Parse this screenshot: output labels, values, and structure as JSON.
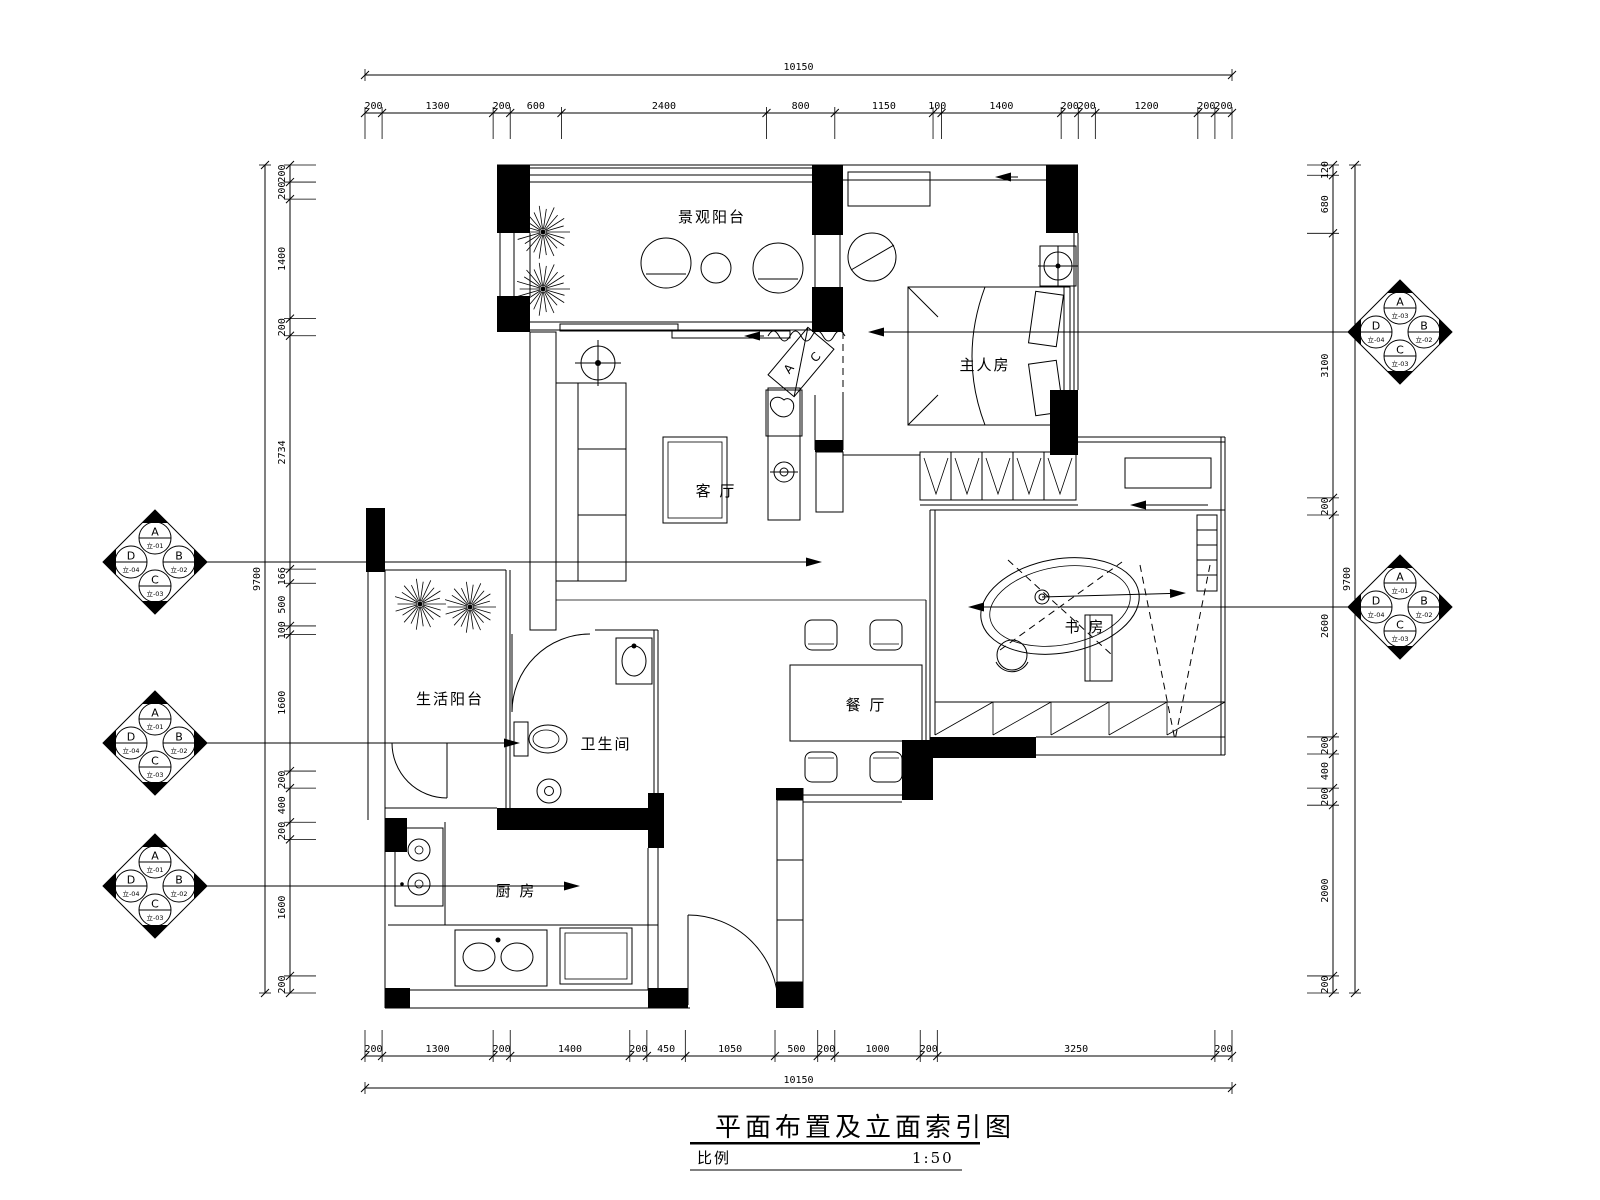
{
  "title_block": {
    "title": "平面布置及立面索引图",
    "scale_label": "比例",
    "scale_value": "1:50"
  },
  "dims": {
    "top": {
      "total": "10150",
      "segments": [
        200,
        1300,
        200,
        600,
        2400,
        800,
        1150,
        100,
        1400,
        200,
        200,
        1200,
        200,
        200
      ]
    },
    "bottom": {
      "total": "10150",
      "segments": [
        200,
        1300,
        200,
        1400,
        200,
        450,
        1050,
        500,
        200,
        1000,
        200,
        3250,
        200
      ]
    },
    "left": {
      "total": "9700",
      "segments": [
        200,
        200,
        1400,
        200,
        2734,
        166,
        500,
        100,
        1600,
        200,
        400,
        200,
        1600,
        200
      ]
    },
    "right": {
      "total": "9700",
      "segments": [
        120,
        680,
        3100,
        200,
        2600,
        200,
        400,
        200,
        2000,
        200
      ]
    }
  },
  "rooms": [
    {
      "name": "景观阳台"
    },
    {
      "name": "主人房"
    },
    {
      "name": "客 厅"
    },
    {
      "name": "生活阳台"
    },
    {
      "name": "卫生间"
    },
    {
      "name": "餐 厅"
    },
    {
      "name": "书 房"
    },
    {
      "name": "厨 房"
    }
  ],
  "labels": {
    "ac_top": "A",
    "ac_bottom": "C"
  },
  "elevation_symbols": [
    {
      "id": "left-living",
      "quadrants": {
        "top": {
          "letter": "A",
          "code": "立-01"
        },
        "right": {
          "letter": "B",
          "code": "立-02"
        },
        "bottom": {
          "letter": "C",
          "code": "立-03"
        },
        "left": {
          "letter": "D",
          "code": "立-04"
        }
      }
    },
    {
      "id": "left-bath",
      "quadrants": {
        "top": {
          "letter": "A",
          "code": "立-01"
        },
        "right": {
          "letter": "B",
          "code": "立-02"
        },
        "bottom": {
          "letter": "C",
          "code": "立-03"
        },
        "left": {
          "letter": "D",
          "code": "立-04"
        }
      }
    },
    {
      "id": "left-kitchen",
      "quadrants": {
        "top": {
          "letter": "A",
          "code": "立-01"
        },
        "right": {
          "letter": "B",
          "code": "立-02"
        },
        "bottom": {
          "letter": "C",
          "code": "立-03"
        },
        "left": {
          "letter": "D",
          "code": "立-04"
        }
      }
    },
    {
      "id": "right-master",
      "quadrants": {
        "top": {
          "letter": "A",
          "code": "立-03"
        },
        "right": {
          "letter": "B",
          "code": "立-02"
        },
        "bottom": {
          "letter": "C",
          "code": "立-03"
        },
        "left": {
          "letter": "D",
          "code": "立-04"
        }
      }
    },
    {
      "id": "right-study",
      "quadrants": {
        "top": {
          "letter": "A",
          "code": "立-01"
        },
        "right": {
          "letter": "B",
          "code": "立-02"
        },
        "bottom": {
          "letter": "C",
          "code": "立-03"
        },
        "left": {
          "letter": "D",
          "code": "立-04"
        }
      }
    }
  ],
  "colors": {
    "line": "#000000",
    "background": "#ffffff"
  }
}
